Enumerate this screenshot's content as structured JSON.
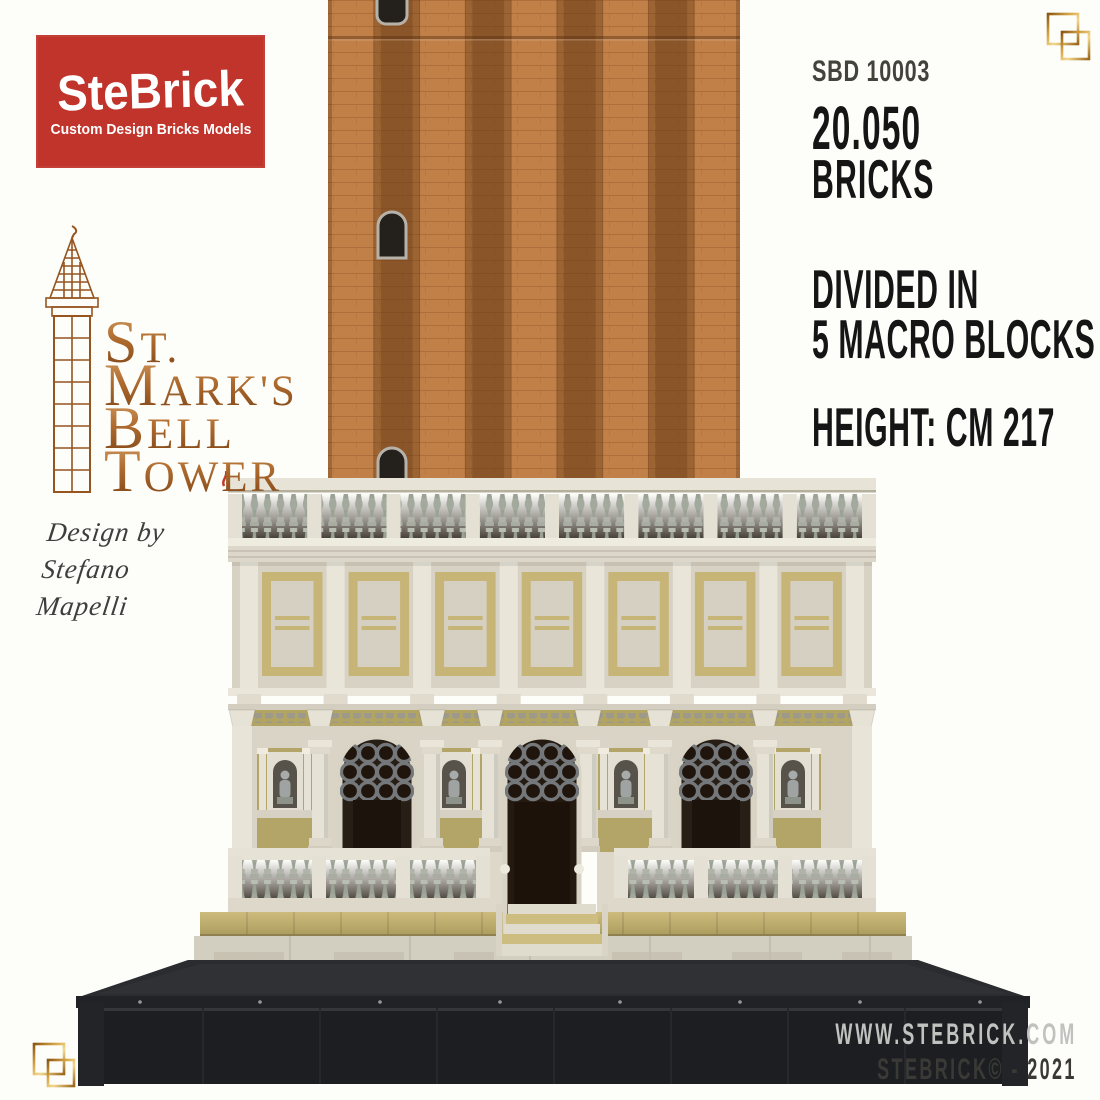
{
  "palette": {
    "background": "#fdfdfa",
    "brand_red": "#c0342b",
    "copper_text": "#a5602c",
    "gold_ornament_light": "#f2d88e",
    "gold_ornament_dark": "#8a5712",
    "ink_dark": "#151515",
    "ink_gray": "#43423b",
    "ink_light_gray": "#c1c1bf",
    "brick_light": "#c28049",
    "brick_dark": "#8a5529",
    "stone_cream": "#e2ded1",
    "stone_shadow": "#cbc5b4",
    "baluster_gray": "#9aa195",
    "olive_gold": "#b3a567",
    "arch_dark": "#241a10",
    "base_black": "#1d1e21"
  },
  "brand": {
    "title": "SteBrick",
    "subtitle": "Custom Design Bricks Models"
  },
  "product_title": {
    "lines": [
      {
        "initial": "S",
        "rest": "T."
      },
      {
        "initial": "M",
        "rest": "ARK'S"
      },
      {
        "initial": "B",
        "rest": "ELL"
      },
      {
        "initial": "T",
        "rest": "OWER"
      }
    ]
  },
  "designer": {
    "lines": [
      "Design by",
      "Stefano",
      "Mapelli"
    ]
  },
  "specs": {
    "code": "SBD 10003",
    "bricks_value": "20.050",
    "bricks_label": "BRICKS",
    "divided_line1": "DIVIDED IN",
    "divided_line2": "5 MACRO BLOCKS",
    "height": "HEIGHT: CM 217"
  },
  "footer": {
    "website": "WWW.STEBRICK.COM",
    "copyright": "STEBRICK© - 2021"
  }
}
